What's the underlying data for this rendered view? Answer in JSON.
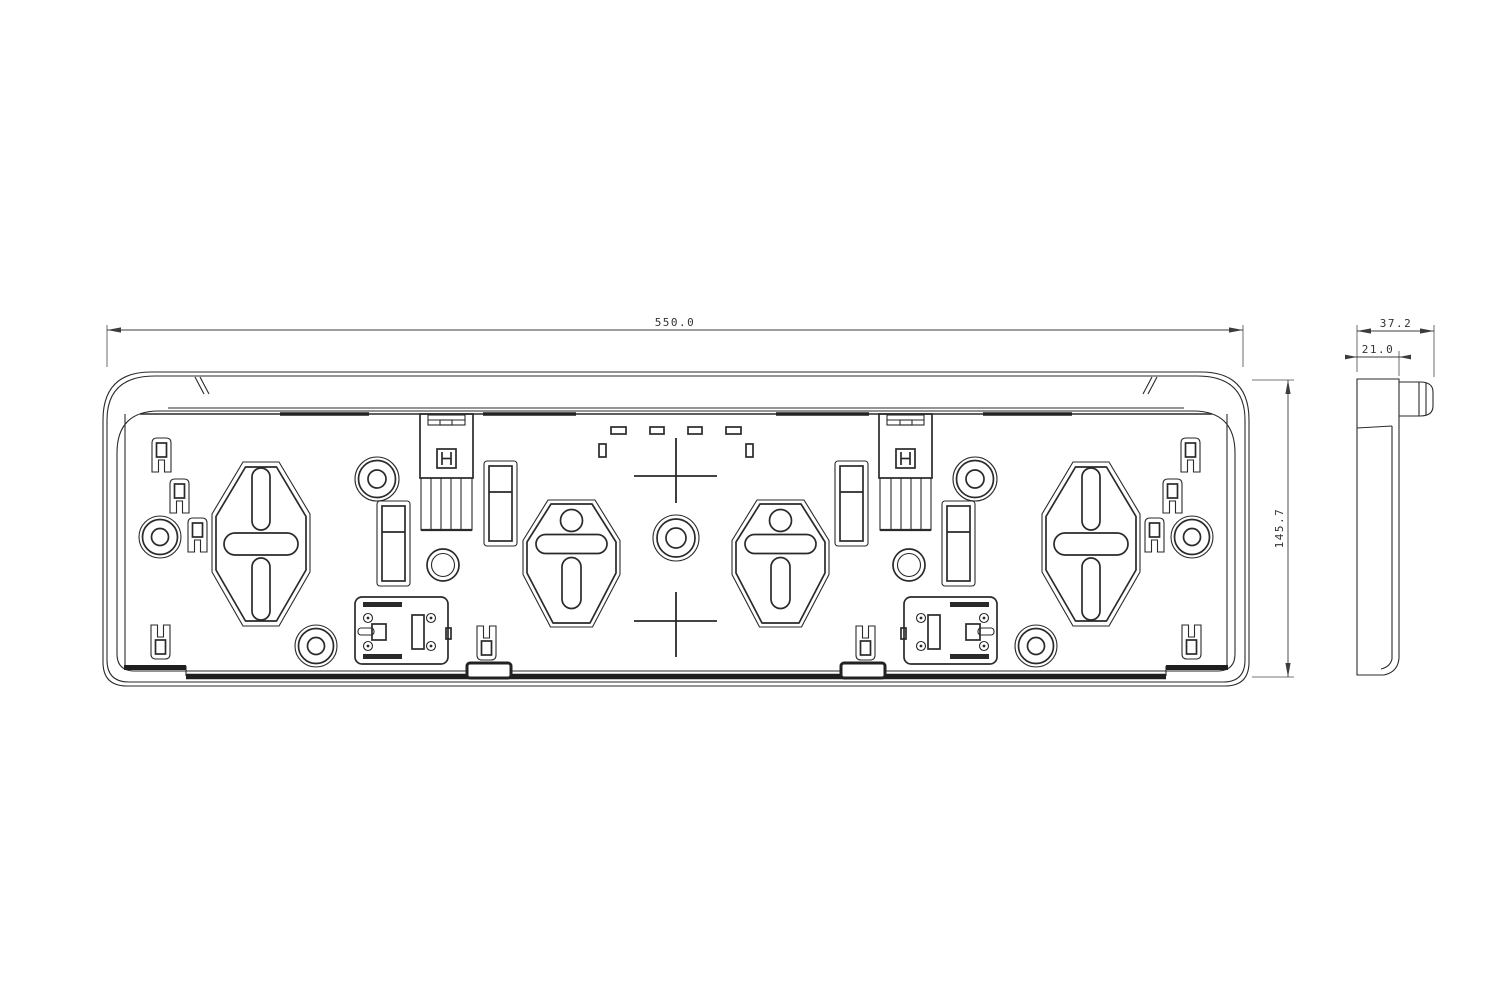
{
  "drawing": {
    "kind": "technical-drawing",
    "background_color": "#ffffff",
    "line_color": "#2a2a2a",
    "dimension_color": "#3c3c3c",
    "views": {
      "front_view": {
        "dimensions": {
          "width_label": "550.0",
          "height_label": "145.7"
        }
      },
      "side_view": {
        "dimensions": {
          "depth_label": "37.2",
          "pocket_depth_label": "21.0"
        }
      }
    }
  }
}
